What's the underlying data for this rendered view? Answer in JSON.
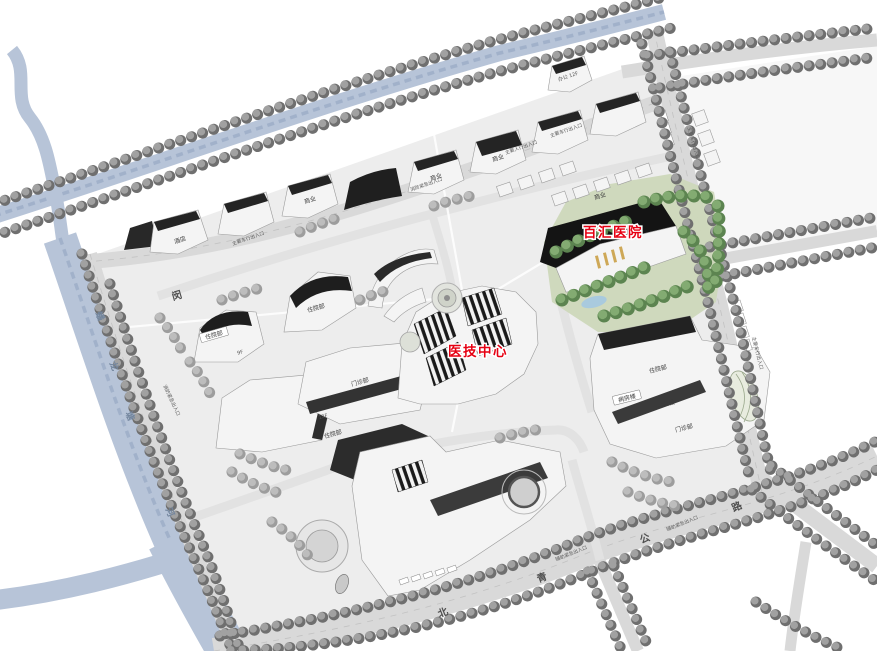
{
  "colors": {
    "label_red": "#e60012",
    "water": "#b7c4d8",
    "road": "#d9d9d9",
    "lawn_green": "#cdd8bb",
    "tree_gray": "#6f6f6f",
    "tree_green": "#5c8450",
    "building_shadow": "#242424"
  },
  "red_labels": {
    "hospital": "百汇医院",
    "medtech": "医技中心"
  },
  "road_names": {
    "beiqing_chars": [
      "北",
      "青",
      "公",
      "路"
    ],
    "min_char": "闵"
  },
  "river_chars": [
    "蟠",
    "龙",
    "塘",
    "河"
  ],
  "building_labels": {
    "hotel": "酒店",
    "retail": "商业",
    "office_12f": "办公 12F",
    "inpatient": "住院部",
    "outpatient": "门诊部",
    "ward_building": "病房楼",
    "internal_medicine": "内科楼",
    "floors_12": "12F",
    "floors_9": "9F"
  },
  "entrance_labels": {
    "main_vehicle": "主要车行出入口",
    "main_pedestrian": "主要人行出入口",
    "fire_emergency": "消防紧急出入口",
    "aux_emergency": "辅助紧急出入口"
  }
}
